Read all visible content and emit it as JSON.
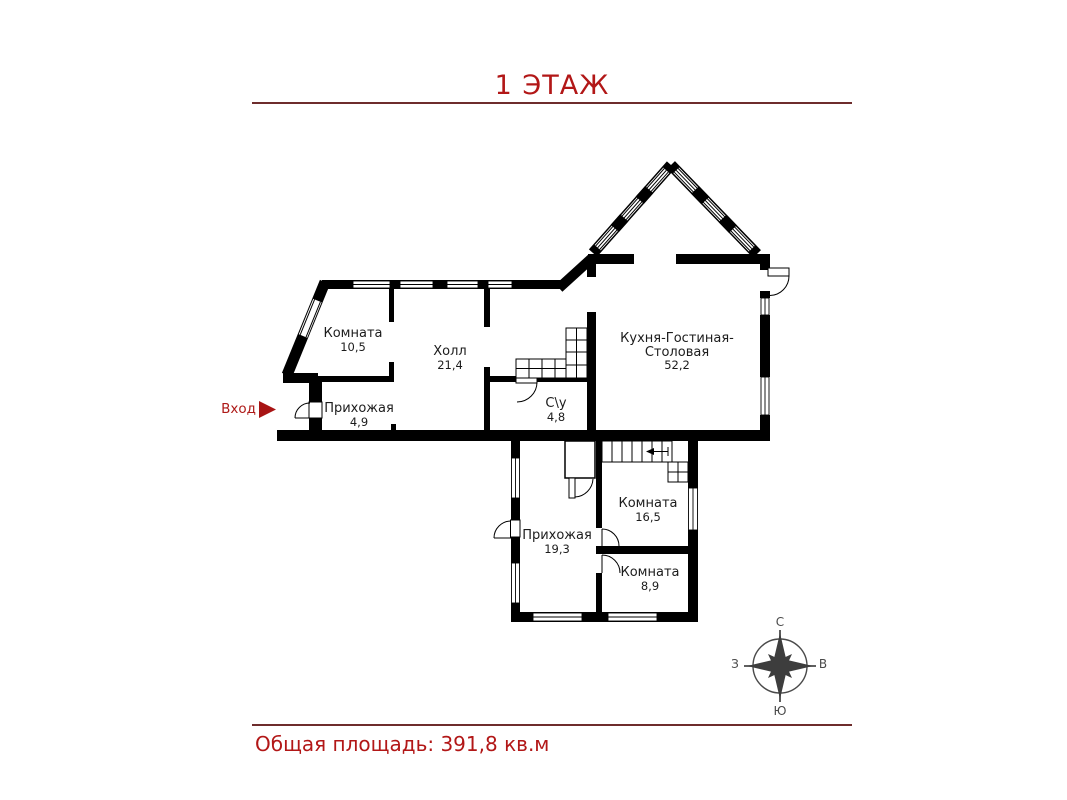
{
  "header": {
    "title": "1 ЭТАЖ"
  },
  "footer": {
    "total_area": "Общая площадь: 391,8 кв.м"
  },
  "entrance": {
    "label": "Вход"
  },
  "colors": {
    "accent_red": "#b21717",
    "rule": "#6e2c2c",
    "wall": "#000000",
    "compass": "#454545"
  },
  "rooms": [
    {
      "name": "Комната",
      "area": "10,5"
    },
    {
      "name": "Холл",
      "area": "21,4"
    },
    {
      "name": "Прихожая",
      "area": "4,9"
    },
    {
      "name": "С\\у",
      "area": "4,8"
    },
    {
      "name_lines": [
        "Кухня-Гостиная-",
        "Столовая"
      ],
      "area": "52,2"
    },
    {
      "name": "Комната",
      "area": "16,5"
    },
    {
      "name": "Прихожая",
      "area": "19,3"
    },
    {
      "name": "Комната",
      "area": "8,9"
    }
  ],
  "compass": {
    "north": "С",
    "south": "Ю",
    "west": "З",
    "east": "В"
  }
}
